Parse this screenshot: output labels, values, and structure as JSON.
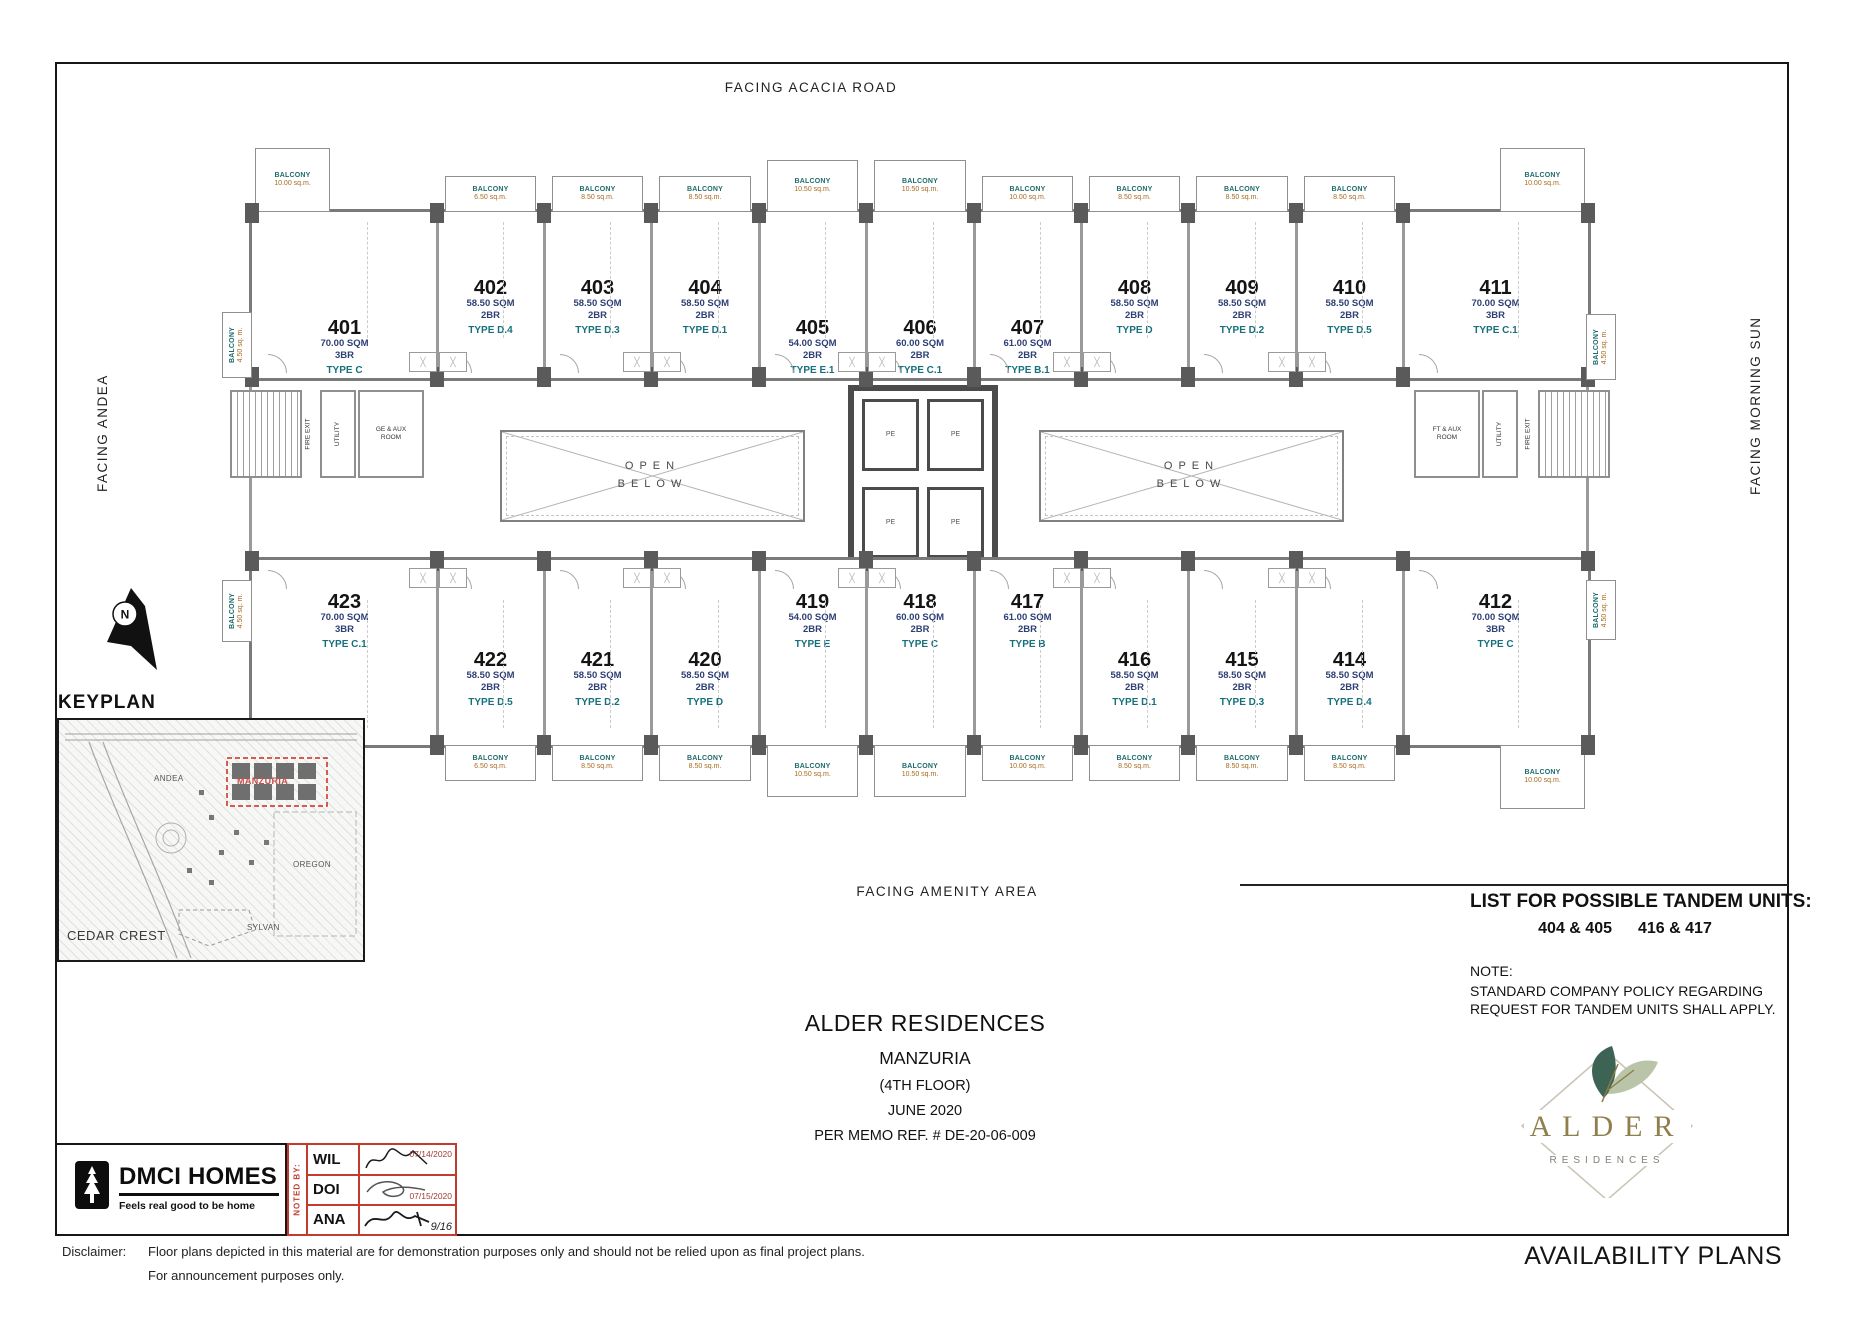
{
  "frame": {
    "facing_top": "FACING ACACIA ROAD",
    "facing_bottom": "FACING AMENITY AREA",
    "facing_left": "FACING ANDEA",
    "facing_right": "FACING MORNING SUN"
  },
  "plan": {
    "balcony_word": "BALCONY",
    "side_balcony": {
      "label": "BALCONY",
      "area": "4.50 sq. m."
    },
    "open_below_line1": "OPEN",
    "open_below_line2": "BELOW",
    "lift_cell": "PE",
    "left_service": [
      "FIRE EXIT",
      "UTILITY",
      "GE & AUX ROOM"
    ],
    "right_service": [
      "FT & AUX ROOM",
      "UTILITY",
      "FIRE EXIT"
    ],
    "top_units": [
      {
        "number": "401",
        "sqm": "70.00 SQM",
        "br": "3BR",
        "type": "TYPE C",
        "balcony": "10.00 sq.m."
      },
      {
        "number": "402",
        "sqm": "58.50 SQM",
        "br": "2BR",
        "type": "TYPE D.4",
        "balcony": "6.50 sq.m."
      },
      {
        "number": "403",
        "sqm": "58.50 SQM",
        "br": "2BR",
        "type": "TYPE D.3",
        "balcony": "8.50 sq.m."
      },
      {
        "number": "404",
        "sqm": "58.50 SQM",
        "br": "2BR",
        "type": "TYPE D.1",
        "balcony": "8.50 sq.m."
      },
      {
        "number": "405",
        "sqm": "54.00 SQM",
        "br": "2BR",
        "type": "TYPE E.1",
        "balcony": "10.50 sq.m."
      },
      {
        "number": "406",
        "sqm": "60.00 SQM",
        "br": "2BR",
        "type": "TYPE C.1",
        "balcony": "10.50 sq.m."
      },
      {
        "number": "407",
        "sqm": "61.00 SQM",
        "br": "2BR",
        "type": "TYPE B.1",
        "balcony": "10.00 sq.m."
      },
      {
        "number": "408",
        "sqm": "58.50 SQM",
        "br": "2BR",
        "type": "TYPE D",
        "balcony": "8.50 sq.m."
      },
      {
        "number": "409",
        "sqm": "58.50 SQM",
        "br": "2BR",
        "type": "TYPE D.2",
        "balcony": "8.50 sq.m."
      },
      {
        "number": "410",
        "sqm": "58.50 SQM",
        "br": "2BR",
        "type": "TYPE D.5",
        "balcony": "8.50 sq.m."
      },
      {
        "number": "411",
        "sqm": "70.00 SQM",
        "br": "3BR",
        "type": "TYPE C.1",
        "balcony": "10.00 sq.m."
      }
    ],
    "bottom_units": [
      {
        "number": "423",
        "sqm": "70.00 SQM",
        "br": "3BR",
        "type": "TYPE C.1",
        "balcony": "10.00 sq.m."
      },
      {
        "number": "422",
        "sqm": "58.50 SQM",
        "br": "2BR",
        "type": "TYPE D.5",
        "balcony": "6.50 sq.m."
      },
      {
        "number": "421",
        "sqm": "58.50 SQM",
        "br": "2BR",
        "type": "TYPE D.2",
        "balcony": "8.50 sq.m."
      },
      {
        "number": "420",
        "sqm": "58.50 SQM",
        "br": "2BR",
        "type": "TYPE D",
        "balcony": "8.50 sq.m."
      },
      {
        "number": "419",
        "sqm": "54.00 SQM",
        "br": "2BR",
        "type": "TYPE E",
        "balcony": "10.50 sq.m."
      },
      {
        "number": "418",
        "sqm": "60.00 SQM",
        "br": "2BR",
        "type": "TYPE C",
        "balcony": "10.50 sq.m."
      },
      {
        "number": "417",
        "sqm": "61.00 SQM",
        "br": "2BR",
        "type": "TYPE B",
        "balcony": "10.00 sq.m."
      },
      {
        "number": "416",
        "sqm": "58.50 SQM",
        "br": "2BR",
        "type": "TYPE D.1",
        "balcony": "8.50 sq.m."
      },
      {
        "number": "415",
        "sqm": "58.50 SQM",
        "br": "2BR",
        "type": "TYPE D.3",
        "balcony": "8.50 sq.m."
      },
      {
        "number": "414",
        "sqm": "58.50 SQM",
        "br": "2BR",
        "type": "TYPE D.4",
        "balcony": "8.50 sq.m."
      },
      {
        "number": "412",
        "sqm": "70.00 SQM",
        "br": "3BR",
        "type": "TYPE C",
        "balcony": "10.00 sq.m."
      }
    ]
  },
  "north_label": "N",
  "keyplan": {
    "title": "KEYPLAN",
    "labels": {
      "manzuria": "MANZURIA",
      "andea": "ANDEA",
      "oregon": "OREGON",
      "sylvan": "SYLVAN",
      "cedar_crest": "CEDAR CREST"
    }
  },
  "title_block": {
    "project": "ALDER RESIDENCES",
    "building": "MANZURIA",
    "floor": "(4TH FLOOR)",
    "date": "JUNE 2020",
    "memo": "PER MEMO REF. # DE-20-06-009"
  },
  "tandem": {
    "title": "LIST FOR POSSIBLE TANDEM UNITS:",
    "pairs": [
      "404 & 405",
      "416 & 417"
    ],
    "note_label": "NOTE:",
    "note_line1": "STANDARD COMPANY POLICY REGARDING",
    "note_line2": "REQUEST FOR TANDEM UNITS SHALL APPLY."
  },
  "dmci": {
    "name": "DMCI HOMES",
    "tagline": "Feels real good to be home"
  },
  "noted_by": {
    "label": "NOTED BY:",
    "rows": [
      {
        "name": "WIL",
        "date": "07/14/2020"
      },
      {
        "name": "DOI",
        "date": "07/15/2020"
      },
      {
        "name": "ANA",
        "date": "9/16"
      }
    ]
  },
  "alder_logo": {
    "name": "ALDER",
    "sub": "RESIDENCES"
  },
  "disclaimer": {
    "label": "Disclaimer:",
    "line1": "Floor plans depicted in this material are for demonstration purposes only and should not be relied upon as final project plans.",
    "line2": "For announcement purposes only."
  },
  "footer": {
    "availability": "AVAILABILITY PLANS"
  }
}
